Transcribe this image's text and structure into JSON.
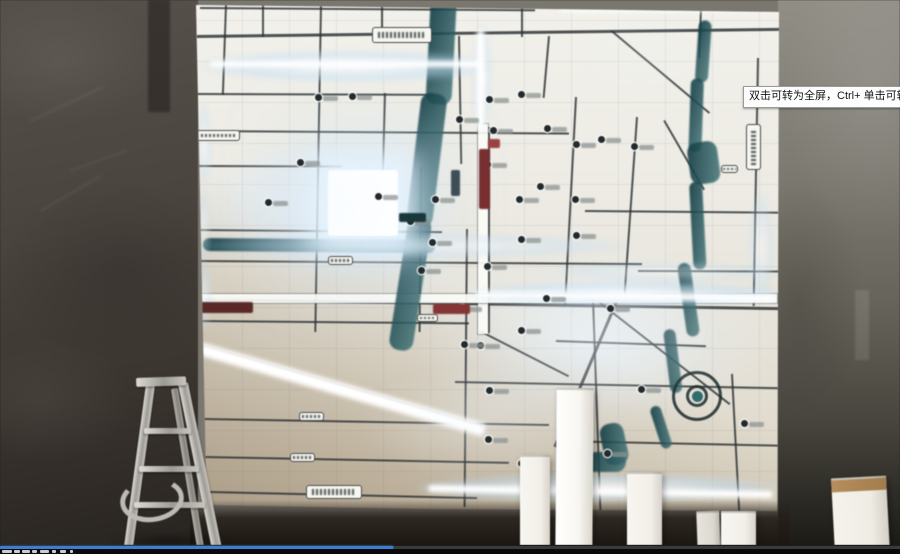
{
  "tooltip": {
    "text": "双击可转为全屏，Ctrl+ 单击可转为"
  },
  "player": {
    "progress_fraction": 0.437,
    "progress_color": "#3d7ed2",
    "track_color": "#3a3a3a",
    "footer_color": "#0a0a0a"
  },
  "palette": {
    "map_paper": "#eeece4",
    "road_dark": "#2a3032",
    "river_teal": "#1d4a50",
    "led_glow": "#cfe7fb",
    "banner_red": "#7c2e2e",
    "wall_left": "#4a443e",
    "wall_right": "#7d7b71",
    "block_white": "#f6f4ee",
    "ladder_silver": "#c8c5bf"
  },
  "scene": {
    "map_offset": [
      195,
      2
    ],
    "roads_h": [
      [
        200,
        7,
        335,
        2,
        0.4
      ],
      [
        197,
        35,
        582,
        3,
        -0.7
      ],
      [
        197,
        93,
        235,
        2,
        0.2
      ],
      [
        197,
        130,
        372,
        2,
        0.4
      ],
      [
        197,
        165,
        145,
        2,
        0.2
      ],
      [
        197,
        229,
        245,
        2,
        0.5
      ],
      [
        197,
        260,
        445,
        2,
        0.4
      ],
      [
        197,
        298,
        582,
        3,
        0.9
      ],
      [
        197,
        320,
        272,
        2,
        0.5
      ],
      [
        455,
        381,
        324,
        2,
        1.1
      ],
      [
        204,
        418,
        345,
        2,
        1.0
      ],
      [
        204,
        456,
        305,
        2,
        1.1
      ],
      [
        209,
        491,
        268,
        2,
        1.3
      ],
      [
        638,
        270,
        140,
        2,
        0.2
      ],
      [
        585,
        210,
        193,
        2,
        0.5
      ],
      [
        556,
        340,
        150,
        2,
        2.0
      ],
      [
        556,
        440,
        222,
        2,
        1.2
      ]
    ],
    "roads_v": [
      [
        225,
        5,
        90,
        2,
        2
      ],
      [
        262,
        5,
        32,
        2,
        0
      ],
      [
        320,
        5,
        327,
        2,
        1
      ],
      [
        381,
        5,
        32,
        2,
        0
      ],
      [
        384,
        93,
        140,
        2,
        1.5
      ],
      [
        420,
        167,
        165,
        2,
        0.5
      ],
      [
        458,
        36,
        128,
        2,
        -1
      ],
      [
        466,
        229,
        278,
        2,
        0.5
      ],
      [
        488,
        127,
        206,
        2,
        0
      ],
      [
        521,
        5,
        32,
        2,
        0
      ],
      [
        548,
        36,
        62,
        2,
        5
      ],
      [
        575,
        97,
        208,
        2,
        3
      ],
      [
        592,
        299,
        212,
        2,
        -2
      ],
      [
        636,
        117,
        186,
        2,
        4
      ],
      [
        700,
        8,
        50,
        2,
        2
      ],
      [
        757,
        58,
        248,
        2,
        1
      ],
      [
        731,
        374,
        138,
        2,
        -3
      ]
    ],
    "roads_diag": [
      [
        612,
        30,
        128,
        2,
        40
      ],
      [
        665,
        120,
        80,
        2,
        60
      ],
      [
        598,
        300,
        168,
        2,
        38
      ],
      [
        618,
        302,
        158,
        3,
        113
      ],
      [
        480,
        330,
        100,
        2,
        27
      ],
      [
        196,
        343,
        298,
        3,
        16
      ]
    ],
    "wide_roads": [
      [
        478,
        124,
        10,
        210
      ],
      [
        197,
        294,
        580,
        9
      ]
    ],
    "rivers": [
      [
        431,
        -4,
        26,
        108,
        3
      ],
      [
        422,
        92,
        26,
        134,
        7
      ],
      [
        409,
        216,
        24,
        134,
        9
      ],
      [
        203,
        238,
        232,
        13,
        0.5
      ],
      [
        699,
        20,
        13,
        62,
        4
      ],
      [
        691,
        78,
        13,
        74,
        2
      ],
      [
        686,
        144,
        30,
        42,
        -8
      ],
      [
        689,
        182,
        13,
        88,
        -3
      ],
      [
        677,
        264,
        13,
        74,
        -8
      ],
      [
        663,
        330,
        12,
        64,
        -7
      ],
      [
        649,
        408,
        11,
        44,
        -18
      ],
      [
        598,
        426,
        24,
        42,
        -12
      ],
      [
        586,
        452,
        40,
        20,
        0
      ]
    ],
    "spiral": {
      "cx": 697,
      "cy": 396,
      "outer": 50,
      "inner": 22,
      "dot": 11
    },
    "glow_strips": [
      [
        203,
        50,
        290,
        32,
        0.85
      ],
      [
        203,
        234,
        425,
        24,
        0.6
      ],
      [
        468,
        282,
        312,
        24,
        0.9
      ],
      [
        556,
        262,
        222,
        20,
        0.45
      ],
      [
        418,
        474,
        362,
        28,
        0.85
      ],
      [
        748,
        192,
        26,
        110,
        0.5
      ],
      [
        196,
        104,
        16,
        80,
        0.55
      ],
      [
        195,
        192,
        16,
        72,
        0.5
      ],
      [
        194,
        262,
        18,
        70,
        0.55
      ],
      [
        472,
        24,
        20,
        108,
        0.6
      ]
    ],
    "glow_cores": [
      [
        210,
        61,
        272,
        6,
        0
      ],
      [
        476,
        291,
        298,
        6,
        0.8
      ],
      [
        428,
        485,
        345,
        7,
        1
      ],
      [
        200,
        342,
        298,
        13,
        16
      ],
      [
        477,
        30,
        7,
        100,
        0
      ],
      [
        560,
        9,
        218,
        3,
        0
      ]
    ],
    "bright_block": [
      328,
      170,
      70,
      66
    ],
    "washes": [
      [
        600,
        335,
        130,
        75,
        0.5
      ],
      [
        300,
        205,
        110,
        70,
        0.35
      ],
      [
        640,
        60,
        80,
        40,
        0.2
      ],
      [
        480,
        420,
        120,
        60,
        0.35
      ]
    ],
    "markers": [
      [
        318,
        97
      ],
      [
        352,
        96
      ],
      [
        300,
        162
      ],
      [
        268,
        202
      ],
      [
        378,
        196
      ],
      [
        410,
        221
      ],
      [
        432,
        242
      ],
      [
        459,
        119
      ],
      [
        489,
        99
      ],
      [
        521,
        94
      ],
      [
        540,
        186
      ],
      [
        521,
        239
      ],
      [
        546,
        298
      ],
      [
        462,
        308
      ],
      [
        521,
        330
      ],
      [
        480,
        345
      ],
      [
        576,
        144
      ],
      [
        601,
        139
      ],
      [
        634,
        146
      ],
      [
        576,
        235
      ],
      [
        610,
        308
      ],
      [
        641,
        389
      ],
      [
        607,
        453
      ],
      [
        744,
        423
      ],
      [
        487,
        266
      ],
      [
        421,
        270
      ],
      [
        464,
        344
      ],
      [
        489,
        390
      ],
      [
        488,
        439
      ],
      [
        521,
        463
      ],
      [
        519,
        199
      ],
      [
        575,
        199
      ],
      [
        487,
        164
      ],
      [
        435,
        199
      ],
      [
        493,
        130
      ],
      [
        547,
        128
      ]
    ],
    "road_labels": [
      [
        372,
        27,
        60,
        16
      ],
      [
        196,
        130,
        44,
        11
      ],
      [
        746,
        124,
        15,
        46
      ],
      [
        299,
        412,
        25,
        9
      ],
      [
        290,
        453,
        25,
        9
      ],
      [
        306,
        485,
        56,
        14
      ],
      [
        328,
        256,
        25,
        9
      ],
      [
        417,
        314,
        21,
        8
      ],
      [
        721,
        165,
        17,
        8
      ]
    ],
    "banners": [
      [
        479,
        149,
        11,
        60,
        "#7c2e2e"
      ],
      [
        433,
        304,
        37,
        10,
        "#8a3434"
      ],
      [
        196,
        302,
        57,
        11,
        "#5c2726"
      ],
      [
        488,
        139,
        12,
        9,
        "#a04040"
      ],
      [
        399,
        213,
        27,
        9,
        "#16393c"
      ],
      [
        451,
        170,
        9,
        26,
        "#3d4e57"
      ]
    ],
    "ladder": {
      "cap": [
        136,
        378,
        50,
        9,
        -2
      ],
      "rails": [
        [
          171,
          389,
          7,
          167,
          -9.3,
          "dim"
        ],
        [
          146,
          384,
          9,
          166,
          7.7,
          ""
        ],
        [
          178,
          384,
          10,
          170,
          -11.6,
          ""
        ]
      ],
      "steps": [
        [
          144,
          428,
          47,
          6
        ],
        [
          139,
          466,
          60,
          6
        ],
        [
          134,
          502,
          71,
          6
        ]
      ],
      "arc": [
        120,
        478,
        64,
        44
      ],
      "shadow": [
        110,
        534,
        120,
        16
      ]
    },
    "blocks": [
      [
        520,
        455,
        30,
        99,
        0,
        "plain"
      ],
      [
        556,
        388,
        37,
        166,
        0.5,
        "bright"
      ],
      [
        627,
        472,
        35,
        82,
        0,
        "plain"
      ],
      [
        697,
        511,
        23,
        43,
        -2,
        "dim"
      ],
      [
        721,
        511,
        35,
        43,
        0,
        "plain"
      ],
      [
        833,
        477,
        55,
        77,
        -3,
        "tan"
      ]
    ],
    "wall_marks": [
      [
        148,
        0,
        22,
        112,
        0,
        "rgba(28,24,20,.5)"
      ],
      [
        30,
        120,
        80,
        2,
        -25,
        "rgba(255,255,255,.06)"
      ],
      [
        70,
        170,
        60,
        2,
        -20,
        "rgba(255,255,255,.05)"
      ],
      [
        40,
        210,
        70,
        2,
        -30,
        "rgba(255,255,255,.06)"
      ],
      [
        855,
        290,
        14,
        70,
        0,
        "rgba(255,255,255,.10)"
      ]
    ],
    "footer_glyphs": [
      [
        2,
        1,
        10,
        3
      ],
      [
        14,
        1,
        6,
        3
      ],
      [
        22,
        1,
        8,
        3
      ],
      [
        32,
        1,
        5,
        3
      ],
      [
        40,
        1,
        9,
        3
      ],
      [
        52,
        1,
        4,
        3
      ],
      [
        60,
        1,
        6,
        3
      ],
      [
        70,
        1,
        3,
        3
      ]
    ]
  }
}
